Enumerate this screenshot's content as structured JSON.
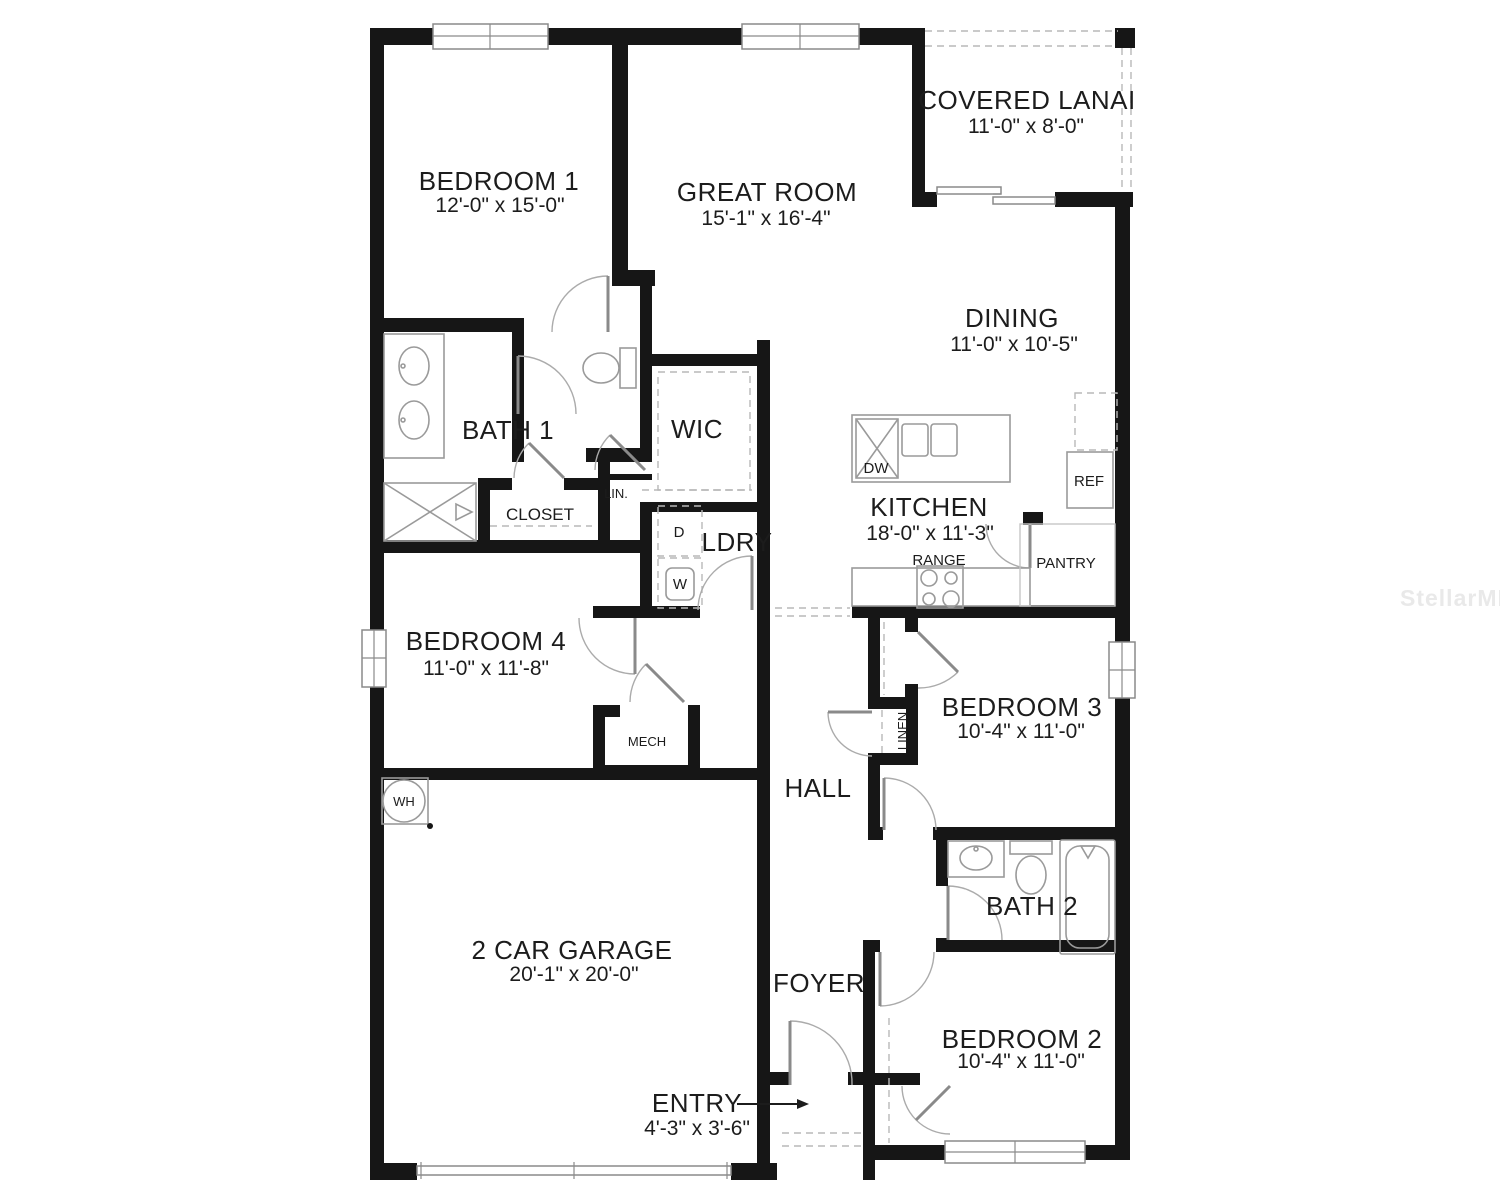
{
  "watermark": "StellarMLS",
  "rooms": {
    "bedroom1": {
      "name": "BEDROOM 1",
      "dims": "12'-0\" x 15'-0\""
    },
    "great_room": {
      "name": "GREAT ROOM",
      "dims": "15'-1\" x 16'-4\""
    },
    "covered_lanai": {
      "name": "COVERED LANAI",
      "dims": "11'-0\" x 8'-0\""
    },
    "dining": {
      "name": "DINING",
      "dims": "11'-0\" x 10'-5\""
    },
    "bath1": {
      "name": "BATH 1"
    },
    "wic": {
      "name": "WIC"
    },
    "kitchen": {
      "name": "KITCHEN",
      "dims": "18'-0\" x 11'-3\""
    },
    "ldry": {
      "name": "LDRY"
    },
    "bedroom4": {
      "name": "BEDROOM 4",
      "dims": "11'-0\" x 11'-8\""
    },
    "mech": {
      "name": "MECH"
    },
    "hall": {
      "name": "HALL"
    },
    "bedroom3": {
      "name": "BEDROOM 3",
      "dims": "10'-4\" x 11'-0\""
    },
    "bath2": {
      "name": "BATH 2"
    },
    "bedroom2": {
      "name": "BEDROOM 2",
      "dims": "10'-4\" x 11'-0\""
    },
    "garage": {
      "name": "2 CAR GARAGE",
      "dims": "20'-1\" x 20'-0\""
    },
    "foyer": {
      "name": "FOYER"
    },
    "entry": {
      "name": "ENTRY",
      "dims": "4'-3\" x 3'-6\""
    }
  },
  "fixtures": {
    "closet": "CLOSET",
    "lin": "LIN.",
    "linen": "LINEN",
    "dryer": "D",
    "washer": "W",
    "dishwasher": "DW",
    "refrigerator": "REF",
    "range": "RANGE",
    "pantry": "PANTRY",
    "water_heater": "WH"
  },
  "colors": {
    "wall": "#161616",
    "fixture": "#9a9a9a",
    "dash": "#b8b8b8",
    "text": "#1c1c1c",
    "watermark": "#e9e9e9"
  }
}
